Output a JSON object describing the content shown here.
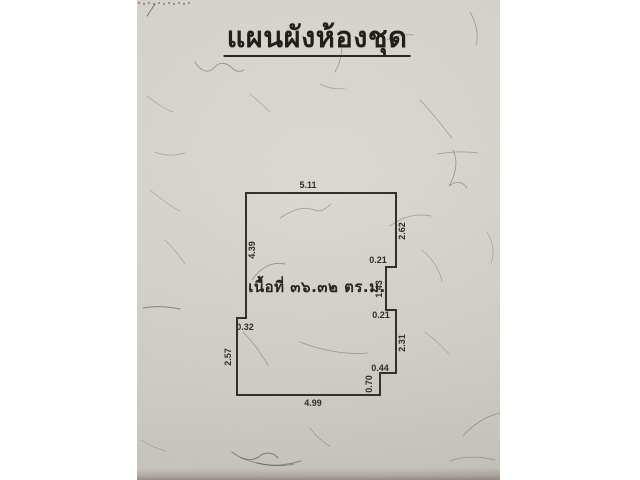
{
  "document": {
    "title": "แผนผังห้องชุด",
    "area_text": "เนื้อที่ ๓๖.๓๒ ตร.ม."
  },
  "floor_plan": {
    "dimensions": {
      "top": "5.11",
      "left_upper": "4.39",
      "left_step": "0.32",
      "left_lower": "2.57",
      "bottom": "4.99",
      "right_upper": "2.62",
      "right_notch_upper": "0.21",
      "right_middle": "1.43",
      "right_notch_lower": "0.21",
      "right_lower": "2.31",
      "right_step": "0.44",
      "right_bottom": "0.70"
    }
  },
  "colors": {
    "paper": "#d6d2cc",
    "ink": "#35302a",
    "margin": "#ffffff"
  }
}
